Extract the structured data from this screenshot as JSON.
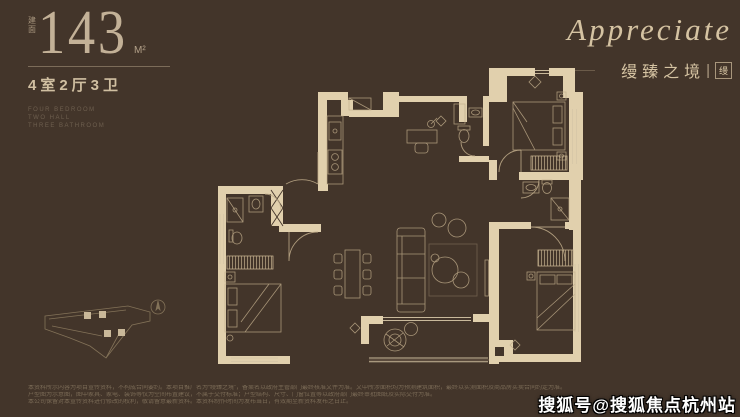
{
  "colors": {
    "background": "#43352a",
    "wall_fill": "#e1d0ad",
    "line": "#c2ae8c",
    "accent_text": "#d5c3a2"
  },
  "header": {
    "area_prefix": "建面",
    "area_value": "143",
    "area_unit": "M²",
    "layout_text": "4室2厅3卫",
    "spec_lines": [
      "FOUR BEDROOM",
      "TWO HALL",
      "THREE BATHROOM"
    ]
  },
  "brand": {
    "script_text": "Appreciate",
    "cn_text": "缦臻之境",
    "divider": "|",
    "seal_text": "缦"
  },
  "footer": {
    "disclaimer_lines": [
      "本资料所示内容为项目宣传资料，不构成合同要约。本项目推广名为“缦臻之境”，备案名以政府主管部门最终核准文件为准。文中所涉面积均为预测建筑面积，最终以实测面积及商品房买卖合同约定为准。",
      "户型图为示意图，图中家具、家电、装饰等仅为空间布置建议，不属于交付标准；户型结构、尺寸、门窗位置等以政府部门最终审批图纸及实际交付为准。",
      "本公司保留对本宣传资料进行修改的权利，敬请留意最新资料。本资料制作时间为发布当日，有效期至新资料发布之日止。"
    ],
    "watermark": "搜狐号@搜狐焦点杭州站"
  }
}
